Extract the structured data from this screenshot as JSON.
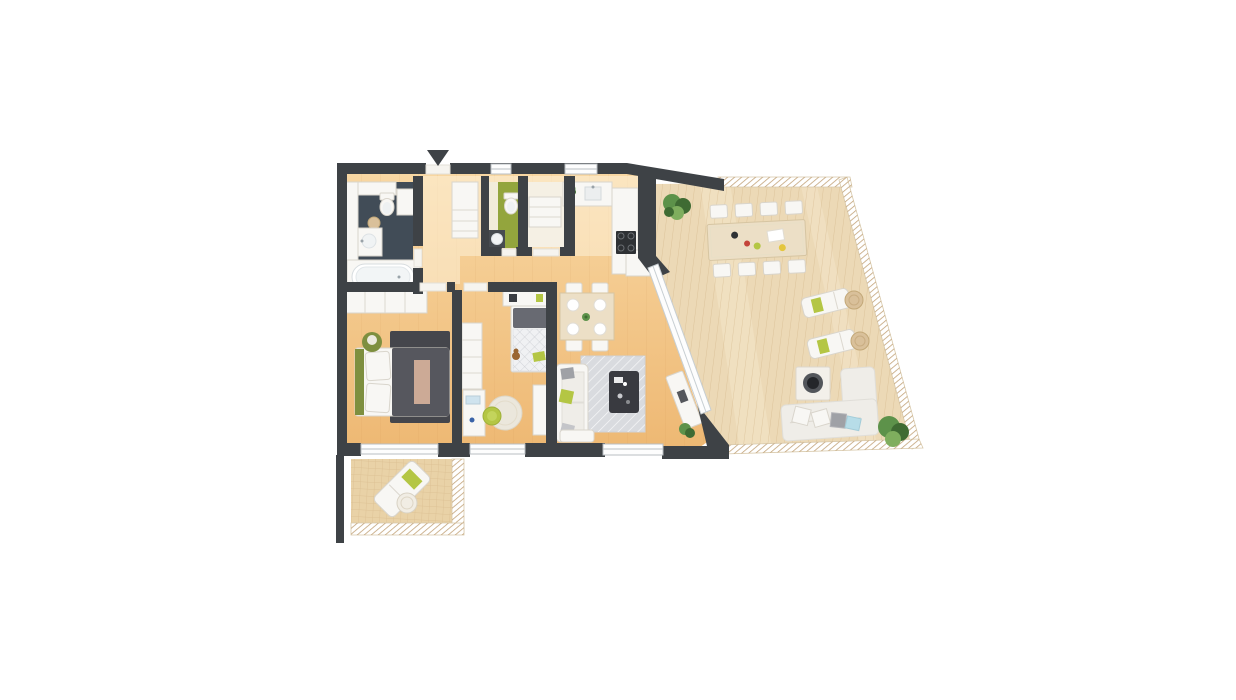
{
  "scene": {
    "type": "3d-floor-plan-top-view",
    "description": "Top-down 3D architectural rendering of an apartment with a large wrap-around wooden terrace and a small balcony",
    "background": "#ffffff"
  },
  "palette": {
    "wall": "#3e4246",
    "floor_light": "#f8d7a2",
    "floor": "#eeb873",
    "hall_overlay": "#fdf3dd",
    "terrace_deck": "#ecd9b6",
    "terrace_deck_light": "#f4e6c9",
    "deck_line": "#c9a877",
    "balcony_deck": "#e9d2a7",
    "railing_hatch": "#c2a379",
    "bathroom_floor": "#414c57",
    "wc_floor": "#93a53d",
    "wc_side_floor": "#f2ecda",
    "storage_floor": "#f5f0e4",
    "accent_green": "#b4c644",
    "accent_green_light": "#c3d45c",
    "olive_green": "#7e8f3f",
    "bed_blanket": "#56575e",
    "bed_rug": "#45464c",
    "kids_duvet": "#686a72",
    "area_rug": "#d9dbdf",
    "coffee_table": "#393a40",
    "wood_table": "#ecdfc6",
    "chair_wood": "#f3ecdb",
    "glass_frame": "#c7ced2",
    "window_frame": "#b9bec2",
    "plant_dark": "#3f6b33",
    "plant_mid": "#5d924a",
    "plant_light": "#7fae5e",
    "wicker": "#d9c09a",
    "pillow_blue": "#b7dde8",
    "pillow_gray": "#9fa1a6",
    "decor_red": "#c4443a",
    "decor_yellow": "#e4c63e",
    "cooktop": "#2e3134",
    "fire_bowl_rim": "#53565b",
    "fire_bowl": "#24262a",
    "throw_tan": "#d9b49c",
    "teddy_brown": "#9a6632",
    "sill": "#f6f4ef"
  },
  "rooms": [
    {
      "name": "bathroom"
    },
    {
      "name": "wc"
    },
    {
      "name": "storage"
    },
    {
      "name": "hallway"
    },
    {
      "name": "kitchen"
    },
    {
      "name": "dining-area"
    },
    {
      "name": "living-room"
    },
    {
      "name": "bedroom"
    },
    {
      "name": "kids-room"
    },
    {
      "name": "terrace"
    },
    {
      "name": "balcony"
    }
  ],
  "contents": {
    "bathroom": [
      "bathtub",
      "toilet",
      "sink-vanity",
      "laundry-basket",
      "cabinets"
    ],
    "wc": [
      "toilet",
      "sink"
    ],
    "storage": [
      "shelf-cabinet"
    ],
    "hallway": [
      "entrance-arrow",
      "wardrobe-with-drawers"
    ],
    "kitchen": [
      "counter-run",
      "sink",
      "cooktop",
      "plant"
    ],
    "dining-area": [
      "square-table",
      "4-chairs",
      "4-plates"
    ],
    "living-room": [
      "sofa",
      "coffee-table",
      "area-rug",
      "sideboard",
      "plant"
    ],
    "bedroom": [
      "double-bed",
      "wardrobe",
      "pouf",
      "dark-rug"
    ],
    "kids-room": [
      "single-bed",
      "shelf",
      "desk",
      "chair",
      "round-rug",
      "teddy-bear",
      "wardrobe"
    ],
    "terrace": [
      "long-dining-table",
      "8-chairs",
      "2-sun-loungers",
      "2-wicker-poufs",
      "fire-table",
      "corner-sofa",
      "2-plants"
    ],
    "balcony": [
      "sun-lounger",
      "wicker-basket"
    ]
  }
}
